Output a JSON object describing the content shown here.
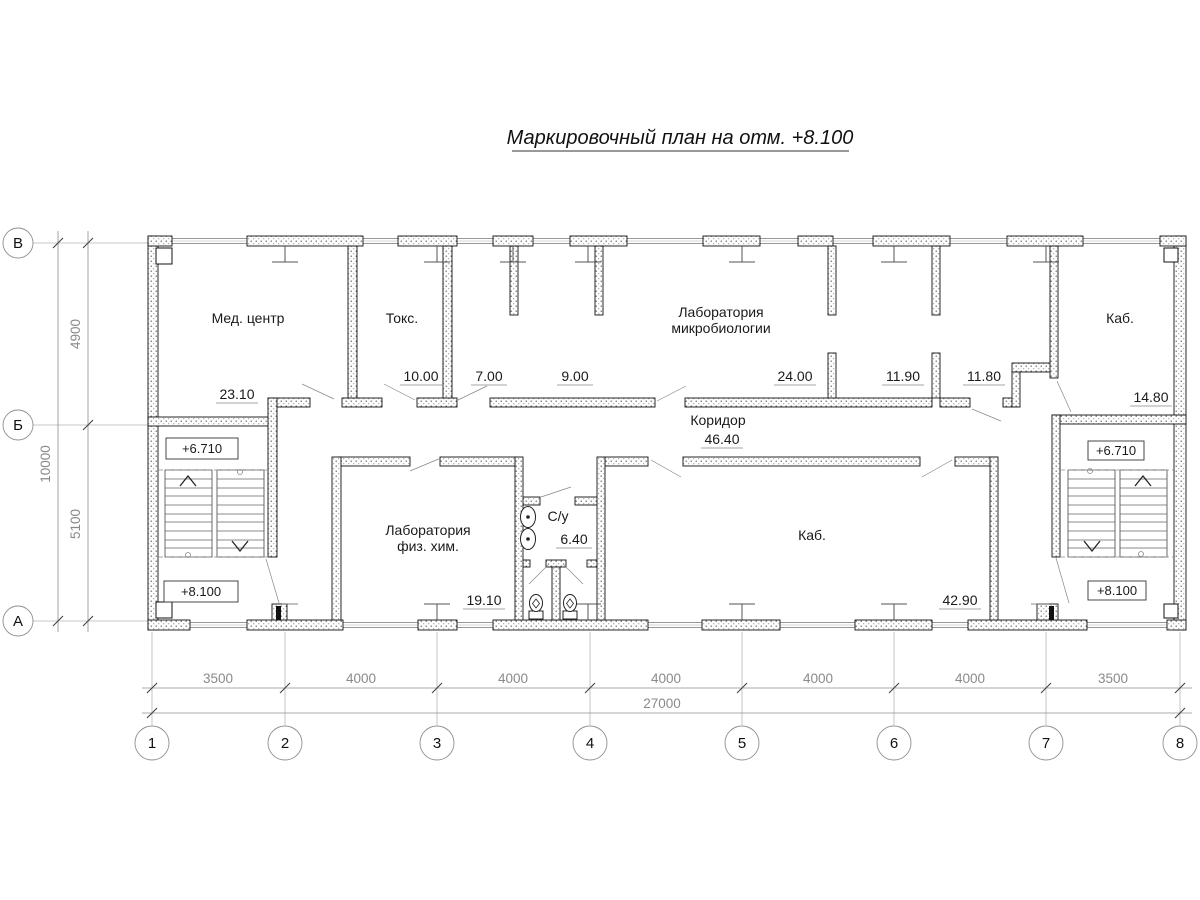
{
  "title": "Маркировочный план на отм. +8.100",
  "axes": {
    "columns": [
      "1",
      "2",
      "3",
      "4",
      "5",
      "6",
      "7",
      "8"
    ],
    "rows": [
      "В",
      "Б",
      "А"
    ]
  },
  "dimensions": {
    "bottom_segments": [
      "3500",
      "4000",
      "4000",
      "4000",
      "4000",
      "4000",
      "3500"
    ],
    "bottom_total": "27000",
    "left_segments": [
      "4900",
      "5100"
    ],
    "left_total": "10000"
  },
  "rooms": {
    "med_center": {
      "name": "Мед. центр",
      "area": "23.10"
    },
    "toks": {
      "name": "Токс.",
      "area": "10.00"
    },
    "room_7": {
      "area": "7.00"
    },
    "room_9": {
      "area": "9.00"
    },
    "lab_micro": {
      "name_line1": "Лаборатория",
      "name_line2": "микробиологии",
      "area": "24.00"
    },
    "room_11_90": {
      "area": "11.90"
    },
    "room_11_80": {
      "area": "11.80"
    },
    "kab_small": {
      "name": "Каб.",
      "area": "14.80"
    },
    "corridor": {
      "name": "Коридор",
      "area": "46.40"
    },
    "lab_phys": {
      "name_line1": "Лаборатория",
      "name_line2": "физ. хим.",
      "area": "19.10"
    },
    "su": {
      "name": "С/у",
      "area": "6.40"
    },
    "kab_large": {
      "name": "Каб.",
      "area": "42.90"
    }
  },
  "elevations": {
    "upper": "+6.710",
    "lower": "+8.100"
  }
}
